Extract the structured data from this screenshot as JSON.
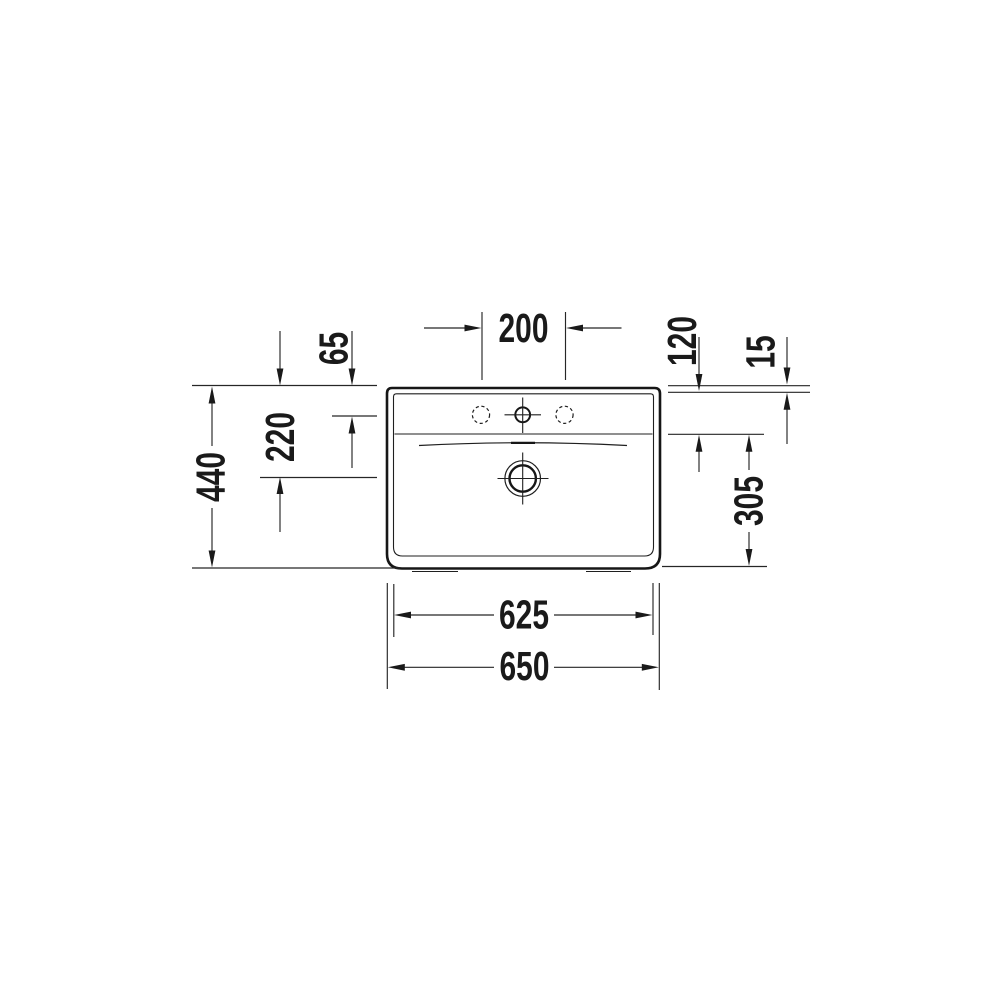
{
  "drawing": {
    "title": "washbasin-top-view-dimension-drawing",
    "unit": "mm",
    "colors": {
      "ink": "#1a1a1a",
      "background": "#ffffff"
    },
    "labels": {
      "tap_hole_spacing": "200",
      "rim_to_tap_center": "65",
      "rim_to_basin_edge": "120",
      "rim_thickness": "15",
      "rim_to_drain_center": "220",
      "overall_depth": "440",
      "basin_front_depth": "305",
      "inner_width": "625",
      "overall_width": "650"
    },
    "features": {
      "faucet_holes": "3 (center drilled, two side holes pre-marked dashed)",
      "drain": "central waste with crosshair",
      "overflow_dash": "short thick dash on deck curve"
    }
  }
}
